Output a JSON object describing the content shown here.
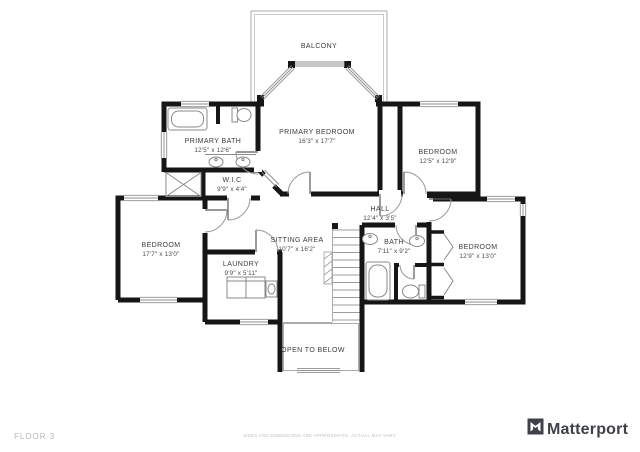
{
  "floor_label": "FLOOR 3",
  "disclaimer": "SIZES AND DIMENSIONS ARE APPROXIMATE, ACTUAL MAY VARY.",
  "brand": {
    "name": "Matterport"
  },
  "colors": {
    "wall": "#161616",
    "thin_line": "#ababab",
    "label_text": "#3d3d3d",
    "muted_text": "#b5b5b5",
    "logo": "#3e4147"
  },
  "rooms": [
    {
      "id": "balcony",
      "name": "BALCONY",
      "dims": ""
    },
    {
      "id": "primary-bath",
      "name": "PRIMARY BATH",
      "dims": "12'5\" x 12'6\""
    },
    {
      "id": "primary-bedroom",
      "name": "PRIMARY BEDROOM",
      "dims": "16'3\" x 17'7\""
    },
    {
      "id": "bedroom-top-right",
      "name": "BEDROOM",
      "dims": "12'5\" x 12'9\""
    },
    {
      "id": "wic",
      "name": "W.I.C",
      "dims": "9'9\" x 4'4\""
    },
    {
      "id": "hall",
      "name": "HALL",
      "dims": "12'4\" x 3'5\""
    },
    {
      "id": "bedroom-left",
      "name": "BEDROOM",
      "dims": "17'7\" x 13'0\""
    },
    {
      "id": "sitting-area",
      "name": "SITTING AREA",
      "dims": "10'7\" x 16'2\""
    },
    {
      "id": "laundry",
      "name": "LAUNDRY",
      "dims": "9'9\" x 5'11\""
    },
    {
      "id": "bath",
      "name": "BATH",
      "dims": "7'11\" x 9'2\""
    },
    {
      "id": "bedroom-right",
      "name": "BEDROOM",
      "dims": "12'9\" x 13'0\""
    },
    {
      "id": "open-below",
      "name": "OPEN TO BELOW",
      "dims": ""
    }
  ]
}
